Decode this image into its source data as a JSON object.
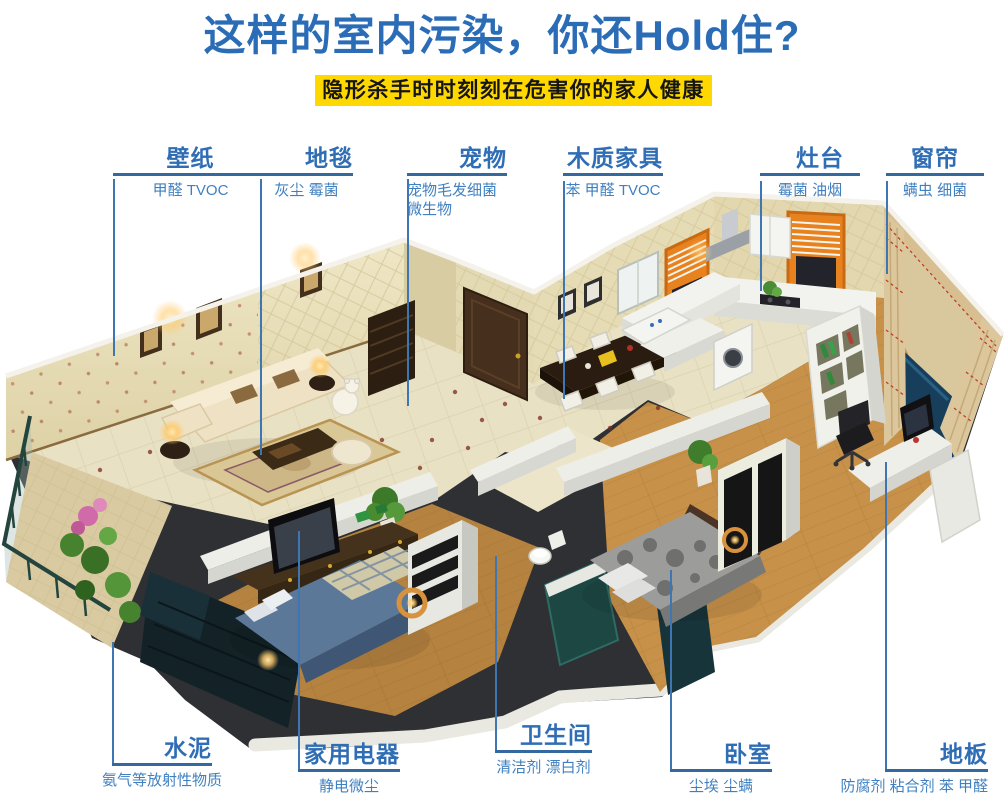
{
  "header": {
    "title": "这样的室内污染，你还Hold住?",
    "banner": "隐形杀手时时刻刻在危害你的家人健康"
  },
  "callouts": {
    "top": [
      {
        "key": "wallpaper",
        "title": "壁纸",
        "pollutants": "甲醛 TVOC"
      },
      {
        "key": "carpet",
        "title": "地毯",
        "pollutants": "灰尘 霉菌"
      },
      {
        "key": "pet",
        "title": "宠物",
        "pollutants": "宠物毛发细菌\n微生物"
      },
      {
        "key": "wood-furniture",
        "title": "木质家具",
        "pollutants": "苯 甲醛 TVOC"
      },
      {
        "key": "stove",
        "title": "灶台",
        "pollutants": "霉菌 油烟"
      },
      {
        "key": "curtain",
        "title": "窗帘",
        "pollutants": "螨虫 细菌"
      }
    ],
    "bottom": [
      {
        "key": "cement",
        "title": "水泥",
        "pollutants": "氨气等放射性物质"
      },
      {
        "key": "appliances",
        "title": "家用电器",
        "pollutants": "静电微尘"
      },
      {
        "key": "bathroom",
        "title": "卫生间",
        "pollutants": "清洁剂 漂白剂"
      },
      {
        "key": "bedroom",
        "title": "卧室",
        "pollutants": "尘埃 尘螨"
      },
      {
        "key": "floor",
        "title": "地板",
        "pollutants": "防腐剂 粘合剂 苯 甲醛"
      }
    ]
  },
  "colors": {
    "title_blue": "#2b6cb7",
    "banner_yellow": "#ffd800",
    "label_blue": "#2f6db5",
    "sub_label_blue": "#4080c0",
    "leader_line_blue": "#3d76b2"
  }
}
